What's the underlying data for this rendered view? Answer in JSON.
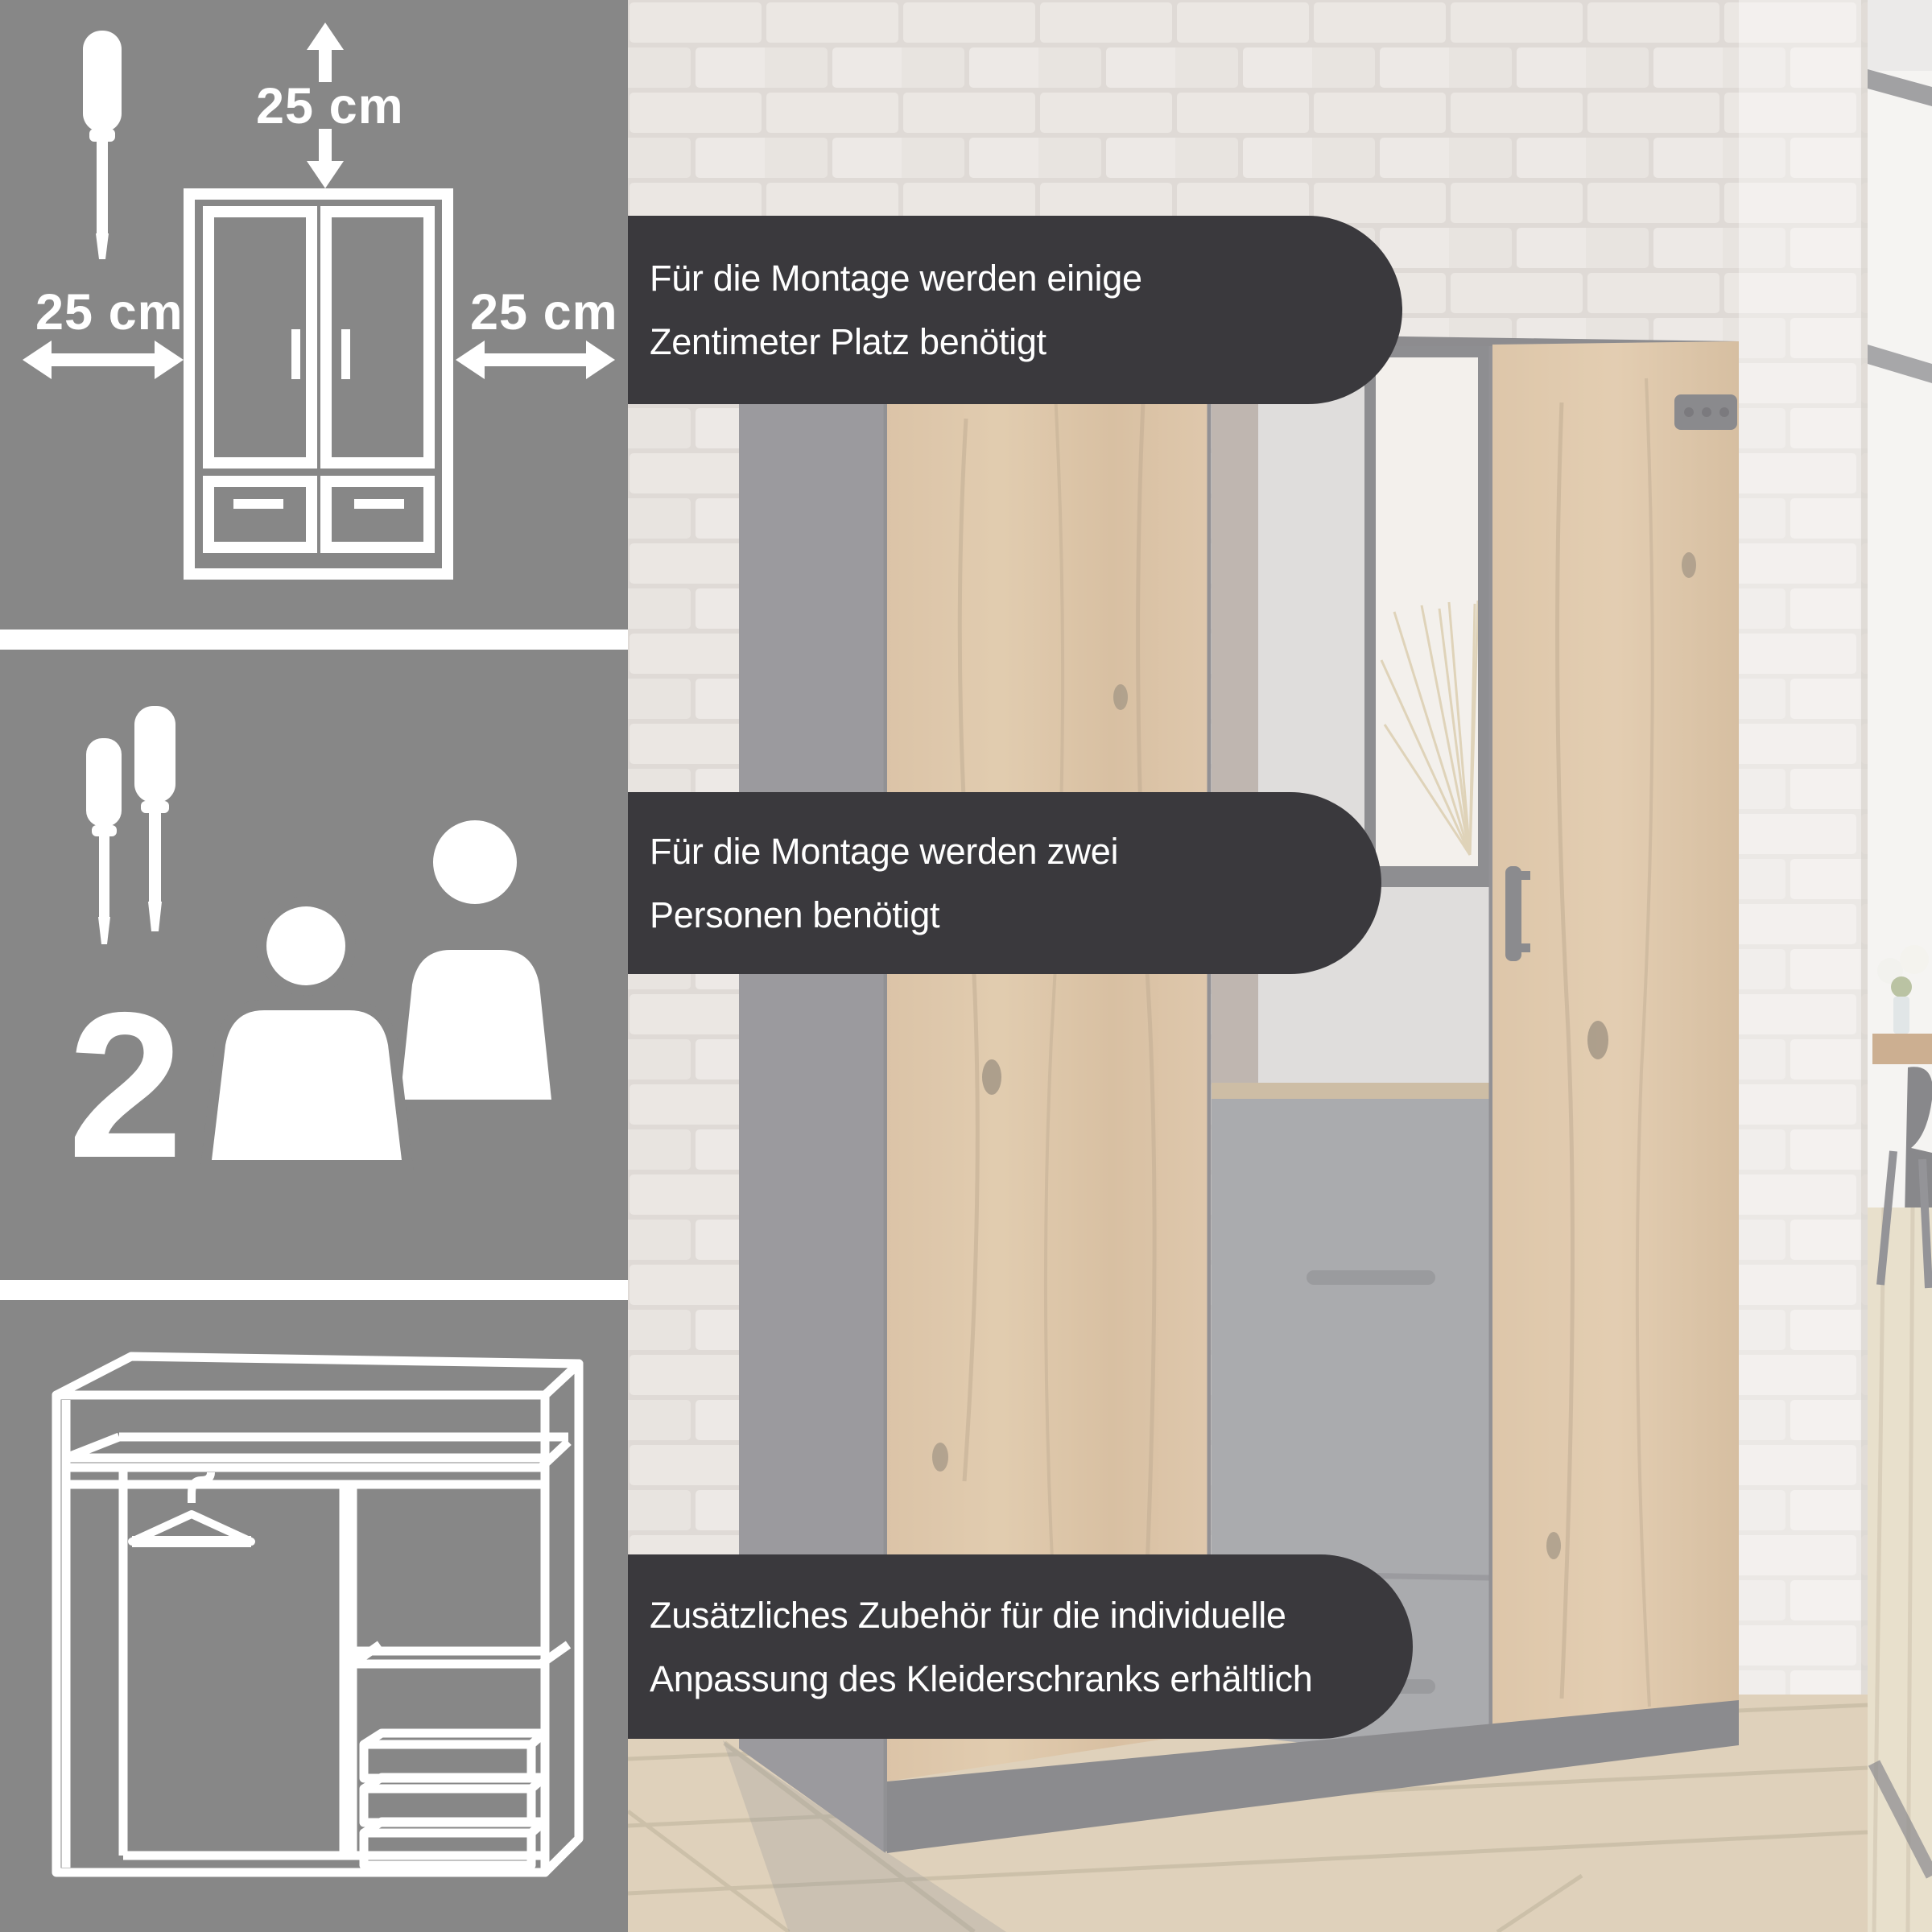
{
  "left_column": {
    "panel_clearance": {
      "top_clearance_label": "25 cm",
      "left_clearance_label": "25 cm",
      "right_clearance_label": "25 cm",
      "icons": [
        "screwdriver-icon",
        "arrow-up-icon",
        "arrow-down-icon",
        "double-arrow-horizontal-icon",
        "wardrobe-front-icon"
      ]
    },
    "panel_two_person_assembly": {
      "person_count": "2",
      "icons": [
        "screwdriver-icon",
        "screwdriver-icon",
        "person-icon",
        "person-icon"
      ]
    },
    "panel_wardrobe_interior": {
      "icons": [
        "wardrobe-interior-icon",
        "clothes-hanger-icon",
        "shelf-icon",
        "drawer-icon"
      ]
    }
  },
  "banners": [
    {
      "line1": "Für die Montage werden einige",
      "line2": "Zentimeter Platz benötigt"
    },
    {
      "line1": "Für die Montage werden zwei",
      "line2": "Personen benötigt"
    },
    {
      "line1": "Zusätzliches Zubehör für die individuelle",
      "line2": "Anpassung des Kleiderschranks erhältlich"
    }
  ],
  "colors": {
    "panel_background": "#878787",
    "separator": "#ffffff",
    "icon": "#ffffff",
    "banner_background": "#3a393d",
    "banner_text": "#ffffff",
    "wood_door": "#c49d6f",
    "anthracite_frame": "#55545a",
    "brick_wall": "#ddd6d0",
    "floor_wood": "#c9b28c"
  }
}
